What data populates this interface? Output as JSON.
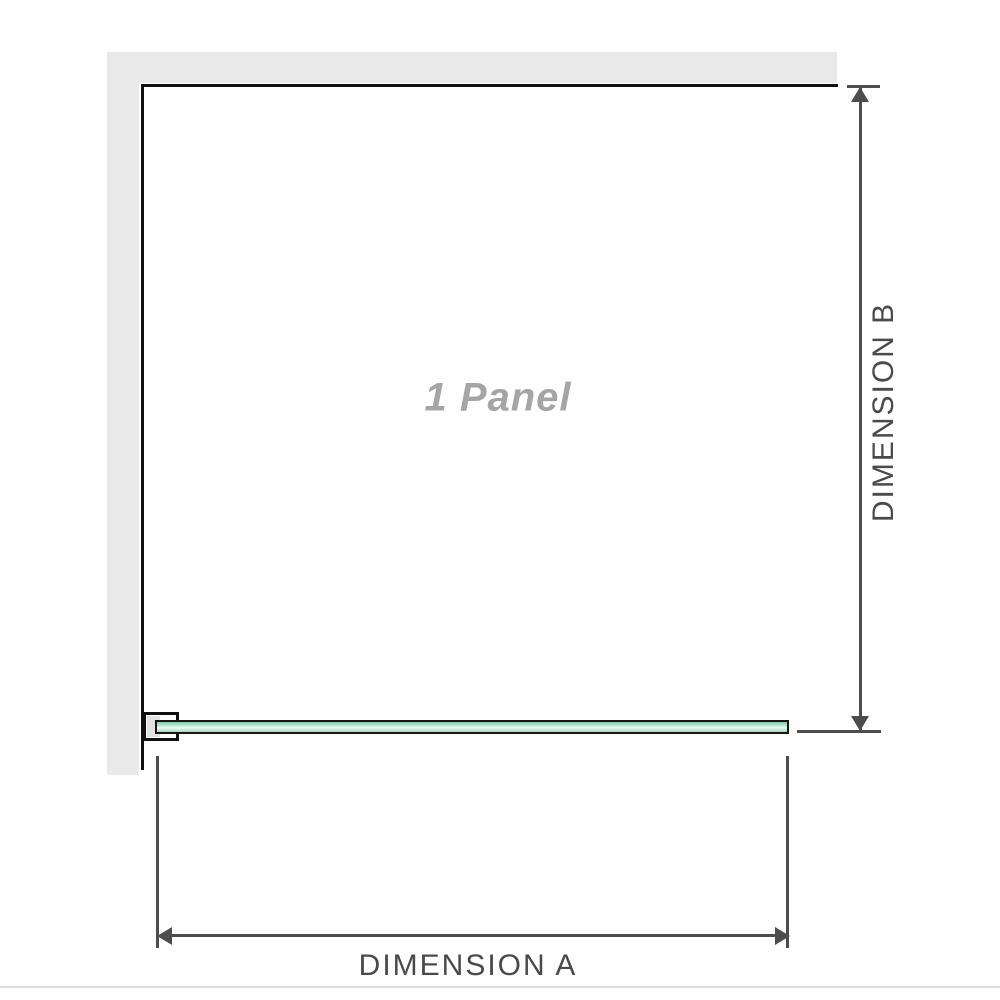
{
  "diagram": {
    "panel_label": "1 Panel",
    "dimension_a": {
      "label": "DIMENSION A"
    },
    "dimension_b": {
      "label": "DIMENSION B"
    }
  },
  "colors": {
    "background": "#fefefe",
    "wall_fill": "#e9e9e9",
    "panel_outline": "#101010",
    "dimension_line": "#4d4d4d",
    "dimension_text": "#4a4a4a",
    "panel_label_text": "#a5a5a5",
    "glass_border": "#161616",
    "glass_green_top": "#7ecca4",
    "glass_green_light": "#eef9f3",
    "glass_green_bottom": "#9fdcbc",
    "bracket_fill": "#e2e2e2",
    "footer_divider": "#dcdbd7"
  }
}
